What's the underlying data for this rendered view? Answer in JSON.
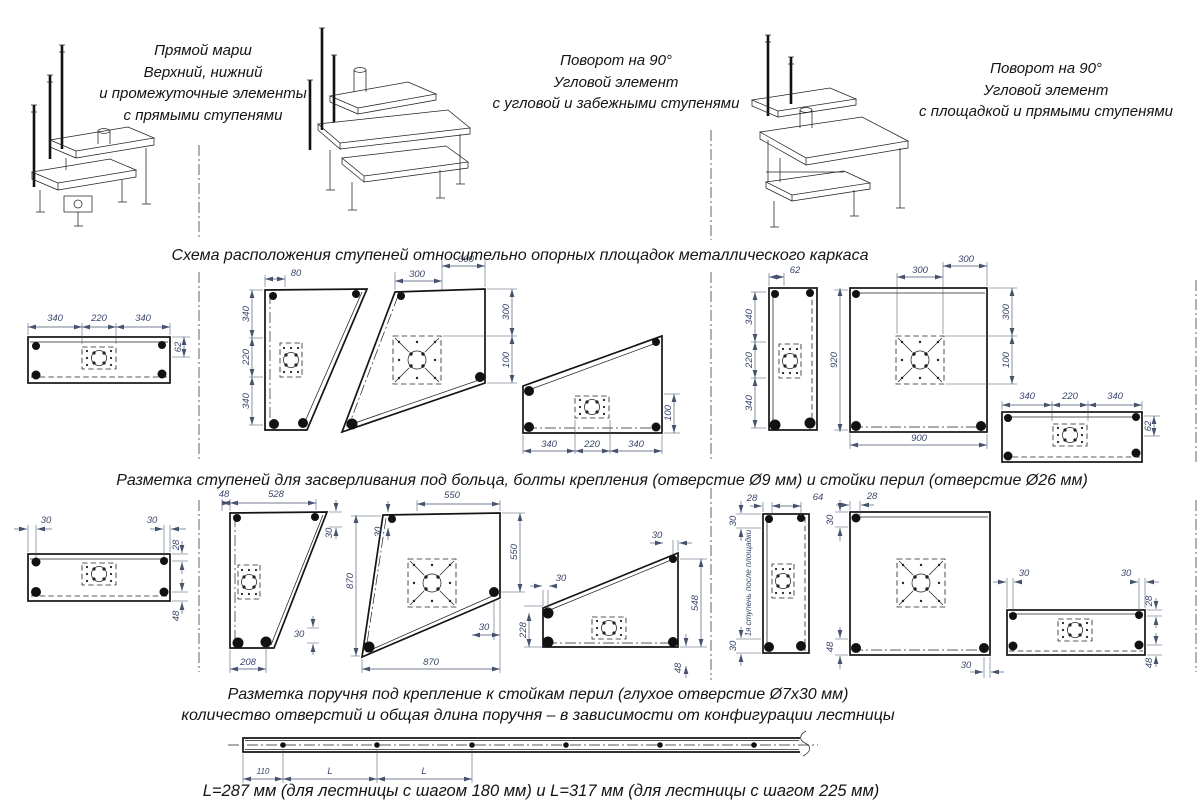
{
  "colors": {
    "line": "#141414",
    "dim_text": "#39466b"
  },
  "captions": {
    "straight": [
      "Прямой марш",
      "Верхний, нижний",
      "и промежуточные элементы",
      "с прямыми ступенями"
    ],
    "winder": [
      "Поворот на 90°",
      "Угловой элемент",
      "с угловой и забежными ступенями"
    ],
    "platform": [
      "Поворот на 90°",
      "Угловой элемент",
      "с площадкой и прямыми ступенями"
    ]
  },
  "headers": {
    "layout": "Схема расположения ступеней относительно опорных площадок металлического каркаса",
    "drilling": "Разметка ступеней для засверливания под больца, болты крепления (отверстие Ø9 мм) и стойки перил (отверстие Ø26 мм)",
    "handrail1": "Разметка поручня под крепление к стойкам перил (глухое отверстие Ø7х30 мм)",
    "handrail2": "количество отверстий и общая длина поручня – в зависимости от конфигурации лестницы",
    "formula": "L=287 мм (для лестницы с шагом 180 мм) и L=317 мм (для лестницы с шагом 225 мм)"
  },
  "row1": {
    "d1": {
      "t1": "340",
      "t2": "220",
      "t3": "340",
      "r": "62"
    },
    "d2": {
      "t": "80",
      "l1": "340",
      "l2": "220",
      "l3": "340"
    },
    "d3": {
      "t1": "300",
      "t2": "300",
      "r1": "300",
      "r2": "100"
    },
    "d4": {
      "b1": "340",
      "b2": "220",
      "b3": "340",
      "r": "100"
    },
    "d5": {
      "t": "62",
      "l1": "340",
      "l2": "220",
      "l3": "340"
    },
    "d6": {
      "t1": "300",
      "t2": "300",
      "l": "920",
      "b": "900",
      "r1": "300",
      "r2": "100"
    },
    "d7": {
      "t1": "340",
      "t2": "220",
      "t3": "340",
      "r": "62"
    }
  },
  "row2": {
    "d1": {
      "t1": "30",
      "t2": "30",
      "r1": "28",
      "r2": "48"
    },
    "d2": {
      "t1": "48",
      "t2": "528",
      "tr": "30",
      "b": "208",
      "br": "30"
    },
    "d3": {
      "t": "550",
      "tl": "30",
      "l": "870",
      "r": "550",
      "b": "870",
      "br": "30"
    },
    "d4": {
      "tr": "30",
      "lt": "30",
      "l": "228",
      "r": "548",
      "br": "48"
    },
    "d5": {
      "t1": "28",
      "t2": "64",
      "l1": "30",
      "l2": "30",
      "note": "1я ступень после площадки"
    },
    "d6": {
      "t": "28",
      "l1": "30",
      "l2": "48",
      "br": "30"
    },
    "d7": {
      "t1": "30",
      "t2": "30",
      "r1": "28",
      "r2": "48"
    }
  },
  "handrail": {
    "d1": "110",
    "d2": "L",
    "d3": "L"
  }
}
